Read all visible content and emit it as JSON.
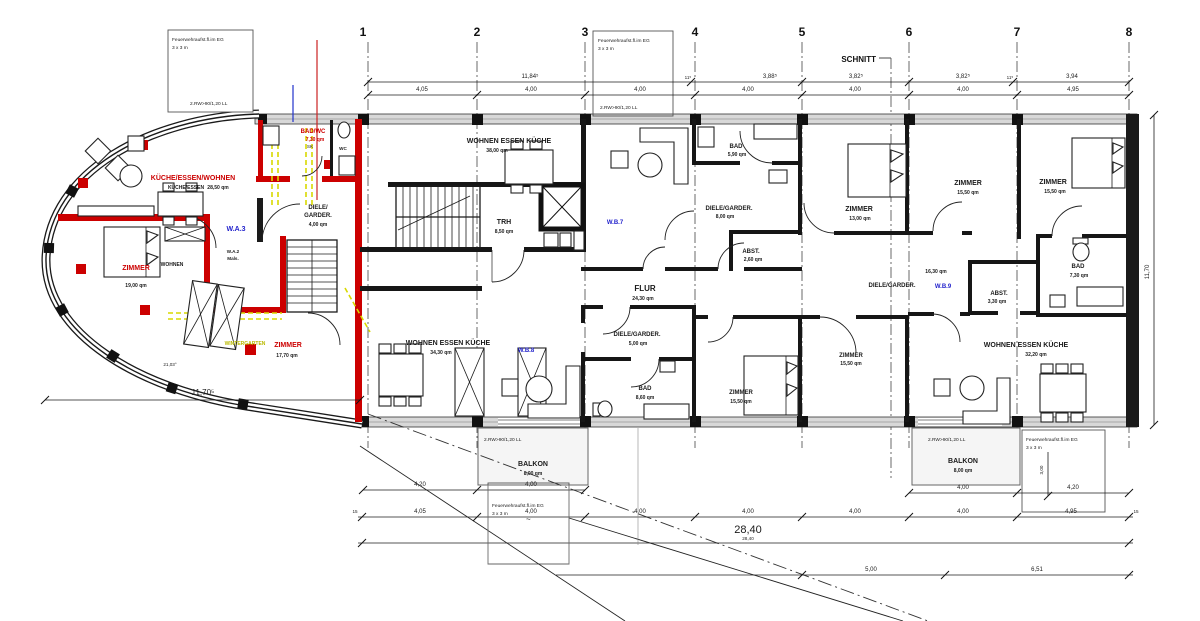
{
  "grid": [
    "1",
    "2",
    "3",
    "4",
    "5",
    "6",
    "7",
    "8"
  ],
  "apartments": {
    "wa3": "W.A.3",
    "wa2_line1": "W.A.2",
    "wa2_line2": "Mals.",
    "wb7": "W.B.7",
    "wb8": "W.B.8",
    "wb9": "W.B.9"
  },
  "rooms": [
    {
      "name": "KÜCHE/ESSEN/WOHNEN",
      "sub": "KÜCHE/ESSEN",
      "qm": "28,50 qm"
    },
    {
      "name": "ZIMMER",
      "qm": "19,00 qm"
    },
    {
      "name": "WOHNEN"
    },
    {
      "name": "BAD/WC",
      "qm": "7,30 qm",
      "sub": "SK"
    },
    {
      "name": "WC"
    },
    {
      "name1": "DIELE/",
      "name2": "GARDER.",
      "qm": "4,00 qm"
    },
    {
      "name": "ZIMMER",
      "qm": "17,70 qm"
    },
    {
      "name": "WINTERGARTEN"
    },
    {
      "name": "TRH",
      "qm": "8,50 qm"
    },
    {
      "name": "WOHNEN ESSEN KÜCHE",
      "qm": "38,00 qm"
    },
    {
      "name": "FLUR",
      "qm": "24,30 qm"
    },
    {
      "name": "WOHNEN ESSEN KÜCHE",
      "qm": "34,30 qm"
    },
    {
      "name": "DIELE/GARDER.",
      "qm": "5,00 qm"
    },
    {
      "name": "BAD",
      "qm": "8,60 qm"
    },
    {
      "name": "BAD",
      "qm": "5,90 qm"
    },
    {
      "name": "DIELE/GARDER.",
      "qm": "8,00 qm"
    },
    {
      "name": "ABST.",
      "qm": "2,60 qm"
    },
    {
      "name": "ZIMMER",
      "qm": "13,00 qm"
    },
    {
      "name": "ZIMMER",
      "qm": "15,50 qm"
    },
    {
      "name": "ZIMMER",
      "qm": "15,50 qm"
    },
    {
      "name": "ZIMMER",
      "qm": "15,50 qm"
    },
    {
      "name": "ZIMMER",
      "qm": "15,50 qm"
    },
    {
      "name": "DIELE/GARDER.",
      "qm": "16,30 qm"
    },
    {
      "name": "ABST.",
      "qm": "3,30 qm"
    },
    {
      "name": "BAD",
      "qm": "7,30 qm"
    },
    {
      "name": "WOHNEN ESSEN KÜCHE",
      "qm": "32,20 qm"
    },
    {
      "name": "BALKON",
      "qm": "8,00 qm"
    },
    {
      "name": "BALKON",
      "qm": "8,00 qm"
    }
  ],
  "notes": {
    "fire_line1": "Feuerwehraufst.fl.im EG",
    "fire_line2": "3 x 3 m",
    "rw": "2.RW>90/1,20 LL",
    "schnitt": "SCHNITT",
    "tilde": "~"
  },
  "dims": {
    "top_upper": [
      "11,84⁵",
      "11⁵",
      "3,88⁵",
      "3,82⁵",
      "3,82⁵",
      "11⁵",
      "3,94"
    ],
    "top_lower": [
      "4,05",
      "4,00",
      "4,00",
      "4,00",
      "4,00",
      "4,00",
      "4,95"
    ],
    "bottom_a": [
      "4,20",
      "4,00",
      "4,00",
      "4,20"
    ],
    "bottom_b": [
      "15",
      "4,05",
      "4,00",
      "4,00",
      "4,00",
      "4,00",
      "4,00",
      "4,95",
      "15"
    ],
    "bottom_total": "28,40",
    "bottom_total_small": "28,40",
    "bottom_c": [
      "5,00",
      "6,51"
    ],
    "right_height": "11,70",
    "left_width": "11,70⁵",
    "angle": "21,03°",
    "box_height": "3,00"
  },
  "colors": {
    "wall": "#1a1a1a",
    "red": "#cc0000",
    "blue": "#2323cc",
    "yellow": "#d8d800",
    "band": "#d8d8d8",
    "balcony": "#f5f5f5"
  }
}
